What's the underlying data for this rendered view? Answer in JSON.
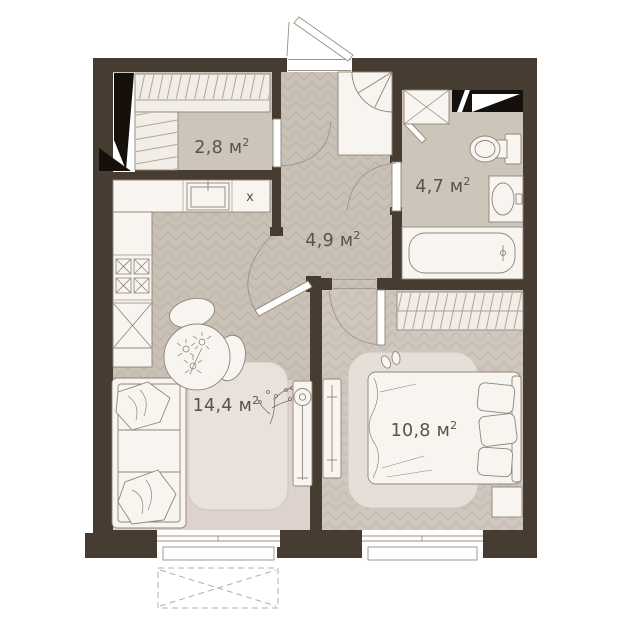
{
  "plan": {
    "type": "apartment-floor-plan",
    "rooms": [
      {
        "id": "wardrobe",
        "name": "walk-in closet",
        "label": "2,8 м",
        "sup": "2"
      },
      {
        "id": "bathroom",
        "name": "bathroom",
        "label": "4,7 м",
        "sup": "2"
      },
      {
        "id": "hallway",
        "name": "hallway",
        "label": "4,9 м",
        "sup": "2"
      },
      {
        "id": "living-kitchen",
        "name": "living-kitchen",
        "label": "14,4 м",
        "sup": "2"
      },
      {
        "id": "bedroom",
        "name": "bedroom",
        "label": "10,8 м",
        "sup": "2"
      }
    ],
    "marks": {
      "kitchen_spot": "х"
    },
    "colors": {
      "wall": "#463c32",
      "shaft_black": "#15100b",
      "floor_base": "#c9c0b6",
      "floor_lines": "#bbb1a6",
      "bedroom_floor": "#cfc6be",
      "plain_floor": "#cdc4ba",
      "carpet": "#ddd3cc",
      "rug_living": "#e9e2db",
      "rug_bedroom": "#e6dfd8",
      "furniture_fill": "#f8f4f0",
      "wardrobe_fill": "#f2ede7",
      "furniture_stroke": "#8f857a",
      "label_text": "#5b5248"
    }
  }
}
